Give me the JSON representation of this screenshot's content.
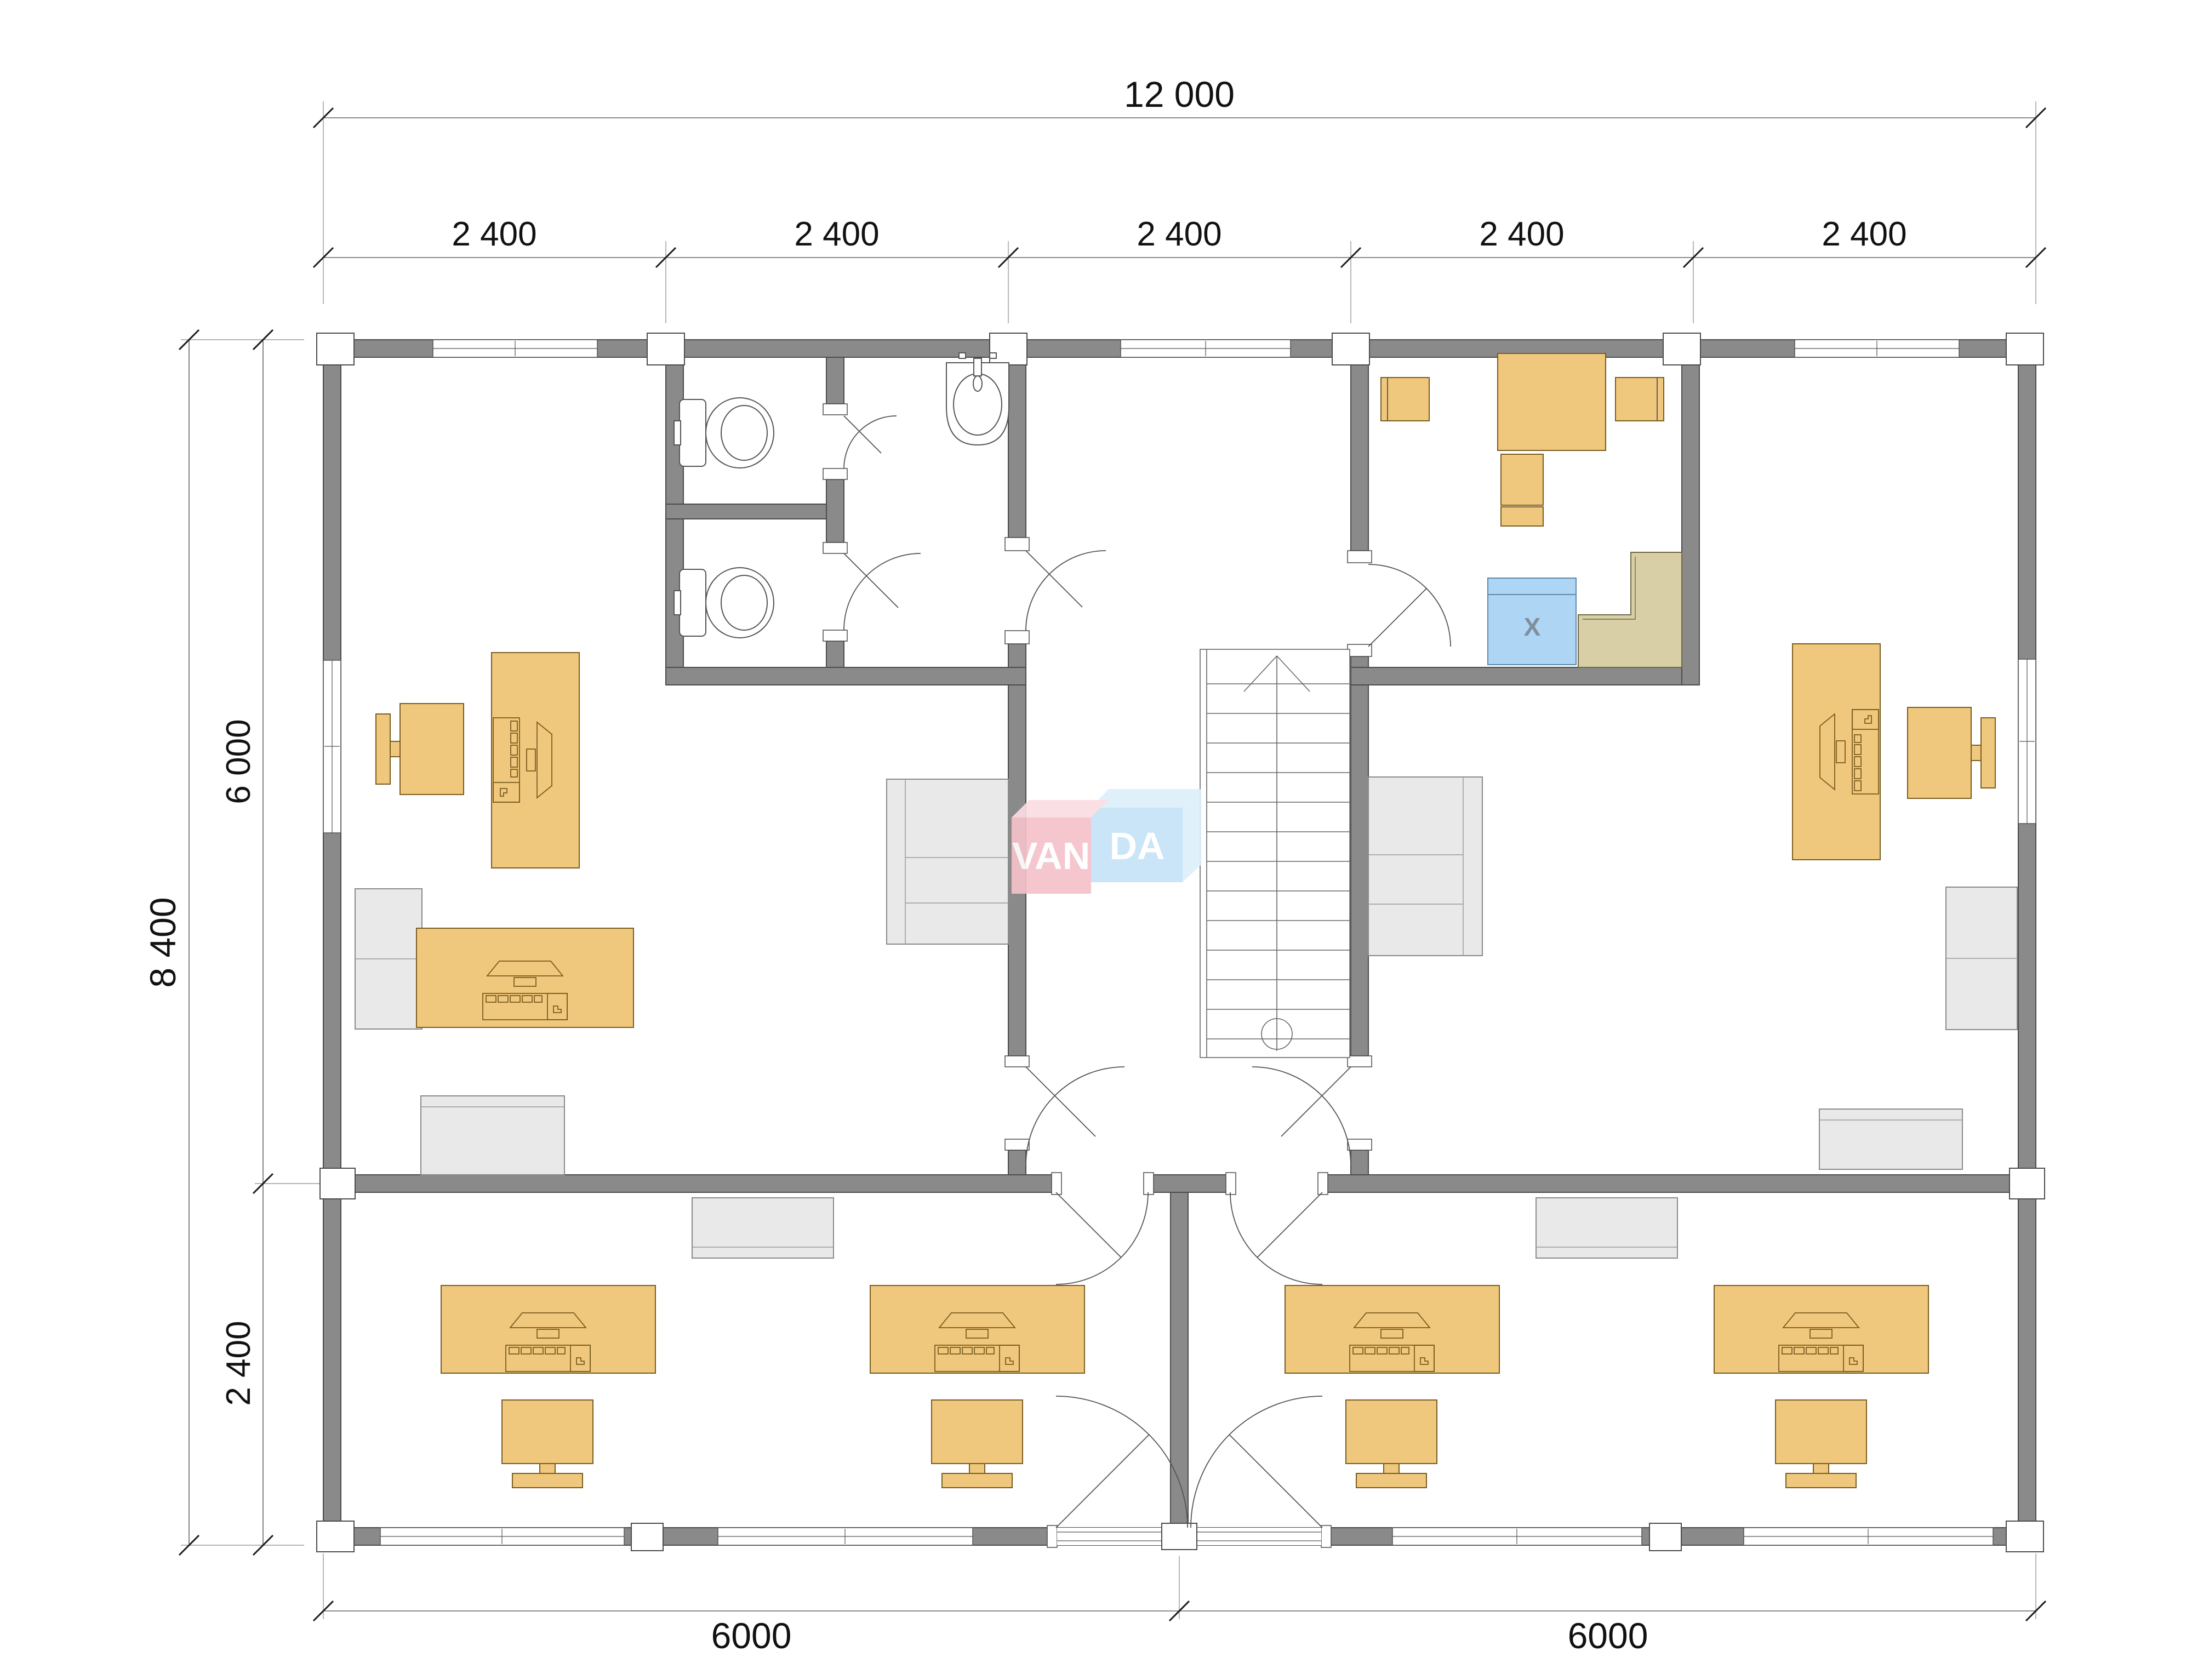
{
  "dims": {
    "total_width": "12 000",
    "bay": [
      "2 400",
      "2 400",
      "2 400",
      "2 400",
      "2 400"
    ],
    "total_height": "8 400",
    "upper_height": "6 000",
    "lower_height": "2 400",
    "bottom": [
      "6000",
      "6000"
    ]
  },
  "logo": {
    "left": "VAN",
    "right": "DA"
  },
  "kitchen": {
    "appliance_mark": "X"
  },
  "colors": {
    "wall": "#8a8a8a",
    "furniture": "#f0c87d",
    "furniture_stroke": "#7a5d20",
    "cabinet": "#e9e9e9",
    "counter": "#d9cfa6",
    "appliance": "#aed6f4",
    "logo_pink": "#f5c2ca",
    "logo_pink_top": "#fadde2",
    "logo_blue": "#c5e3f7",
    "logo_blue_top": "#ddeffb",
    "logo_text": "#ffffff"
  }
}
